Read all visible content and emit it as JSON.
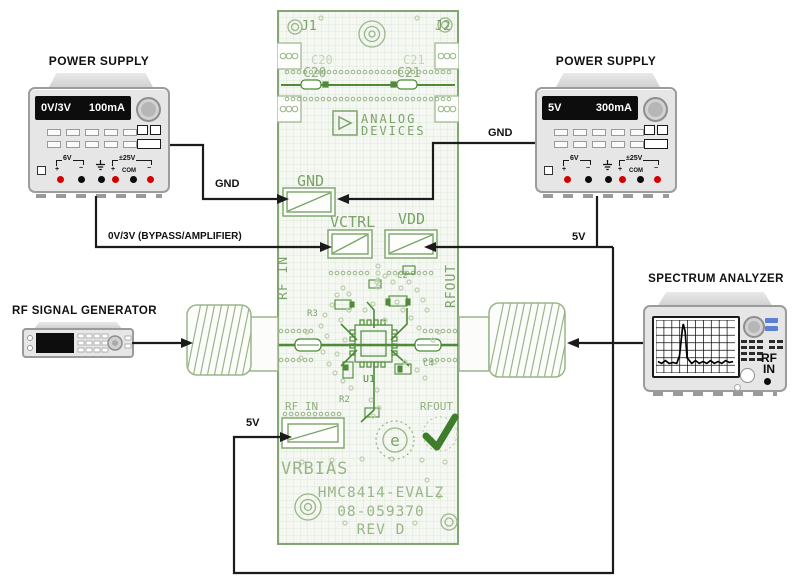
{
  "psu_left": {
    "title": "POWER SUPPLY",
    "display_voltage": "0V/3V",
    "display_current": "100mA",
    "term_6v": "6V",
    "term_25v": "±25V",
    "com": "COM",
    "plus": "+",
    "minus": "−"
  },
  "psu_right": {
    "title": "POWER SUPPLY",
    "display_voltage": "5V",
    "display_current": "300mA",
    "term_6v": "6V",
    "term_25v": "±25V",
    "com": "COM",
    "plus": "+",
    "minus": "−"
  },
  "rf_generator": {
    "title": "RF SIGNAL GENERATOR"
  },
  "spectrum_analyzer": {
    "title": "SPECTRUM ANALYZER",
    "rf_line1": "RF",
    "rf_line2": "IN"
  },
  "wires": {
    "gnd_left": "GND",
    "gnd_right": "GND",
    "bypass": "0V/3V (BYPASS/AMPLIFIER)",
    "v5_vdd": "5V",
    "v5_vrbias": "5V"
  },
  "pcb": {
    "j1": "J1",
    "j2": "J2",
    "c20": "C20",
    "c21": "C21",
    "brand1": "ANALOG",
    "brand2": "DEVICES",
    "gnd": "GND",
    "vctrl": "VCTRL",
    "vdd": "VDD",
    "rfin": "RF IN",
    "rfout": "RFOUT",
    "u1": "U1",
    "c2": "C2",
    "r2": "R2",
    "r3": "R3",
    "c4": "C4",
    "vrbias": "VRBIAS",
    "e_mark": "e",
    "part_number": "HMC8414-EVALZ",
    "serial": "08-059370",
    "rev": "REV D"
  },
  "colors": {
    "silk_pale": "#bccfae",
    "silk_mid": "#7ba369",
    "silk_dark": "#4e8a38",
    "check_green": "#3d7d2b",
    "wire": "#1b1b1b",
    "blue_button": "#5b7fd2",
    "terminal_red": "#d40000"
  }
}
